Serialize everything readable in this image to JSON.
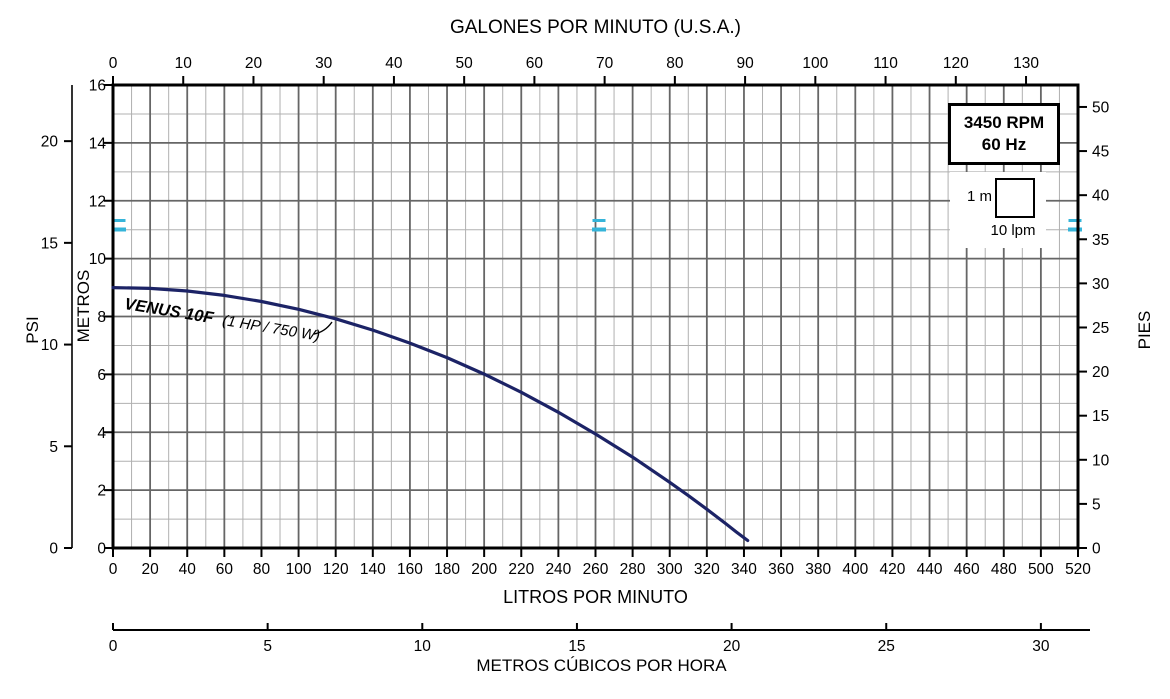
{
  "chart_data": {
    "type": "line",
    "title": "VENUS 10F pump performance curve",
    "legend_position": "top-right",
    "grid": {
      "x_minor_step_lpm": 10,
      "x_major_step_lpm": 20,
      "y_minor_step_m": 1,
      "y_major_step_m": 2,
      "minor_color": "#b0b0b0",
      "major_color": "#666666",
      "border_color": "#000000"
    },
    "axes": {
      "x_top": {
        "label": "GALONES POR MINUTO (U.S.A.)",
        "unit": "gpm",
        "range": [
          0,
          137.4
        ],
        "ticks": [
          0,
          10,
          20,
          30,
          40,
          50,
          60,
          70,
          80,
          90,
          100,
          110,
          120,
          130
        ]
      },
      "x_bottom": {
        "label": "LITROS POR MINUTO",
        "unit": "lpm",
        "range": [
          0,
          520
        ],
        "ticks": [
          0,
          20,
          40,
          60,
          80,
          100,
          120,
          140,
          160,
          180,
          200,
          220,
          240,
          260,
          280,
          300,
          320,
          340,
          360,
          380,
          400,
          420,
          440,
          460,
          480,
          500,
          520
        ]
      },
      "x_bottom2": {
        "label": "METROS CÚBICOS POR HORA",
        "unit": "m3h",
        "range": [
          0,
          31.2
        ],
        "ticks": [
          0,
          5,
          10,
          15,
          20,
          25,
          30
        ]
      },
      "y_left": {
        "label": "METROS",
        "unit": "m",
        "range": [
          0,
          16
        ],
        "ticks": [
          0,
          2,
          4,
          6,
          8,
          10,
          12,
          14,
          16
        ]
      },
      "y_left_outer": {
        "label": "PSI",
        "unit": "psi",
        "range": [
          0,
          22.76
        ],
        "ticks": [
          0,
          5,
          10,
          15,
          20
        ]
      },
      "y_right": {
        "label": "PIES",
        "unit": "ft",
        "range": [
          0,
          52.49
        ],
        "ticks": [
          0,
          5,
          10,
          15,
          20,
          25,
          30,
          35,
          40,
          45,
          50
        ]
      }
    },
    "legend": {
      "line1": "3450 RPM",
      "line2": "60 Hz"
    },
    "scale_indicator": {
      "v_label": "1 m",
      "h_label": "10 lpm"
    },
    "registration_marks": {
      "color": "#35b4d9"
    },
    "series": [
      {
        "name": "VENUS 10F",
        "spec": "(1 HP / 750 W)",
        "color": "#1c2366",
        "x_unit": "lpm",
        "y_unit": "m",
        "points_lpm_m": [
          [
            0,
            9.0
          ],
          [
            20,
            8.97
          ],
          [
            40,
            8.88
          ],
          [
            60,
            8.73
          ],
          [
            80,
            8.52
          ],
          [
            100,
            8.25
          ],
          [
            120,
            7.92
          ],
          [
            140,
            7.53
          ],
          [
            160,
            7.08
          ],
          [
            180,
            6.58
          ],
          [
            200,
            6.01
          ],
          [
            220,
            5.38
          ],
          [
            240,
            4.69
          ],
          [
            260,
            3.94
          ],
          [
            280,
            3.14
          ],
          [
            300,
            2.27
          ],
          [
            310,
            1.81
          ],
          [
            320,
            1.34
          ],
          [
            330,
            0.85
          ],
          [
            336,
            0.55
          ],
          [
            342,
            0.26
          ]
        ]
      }
    ]
  }
}
